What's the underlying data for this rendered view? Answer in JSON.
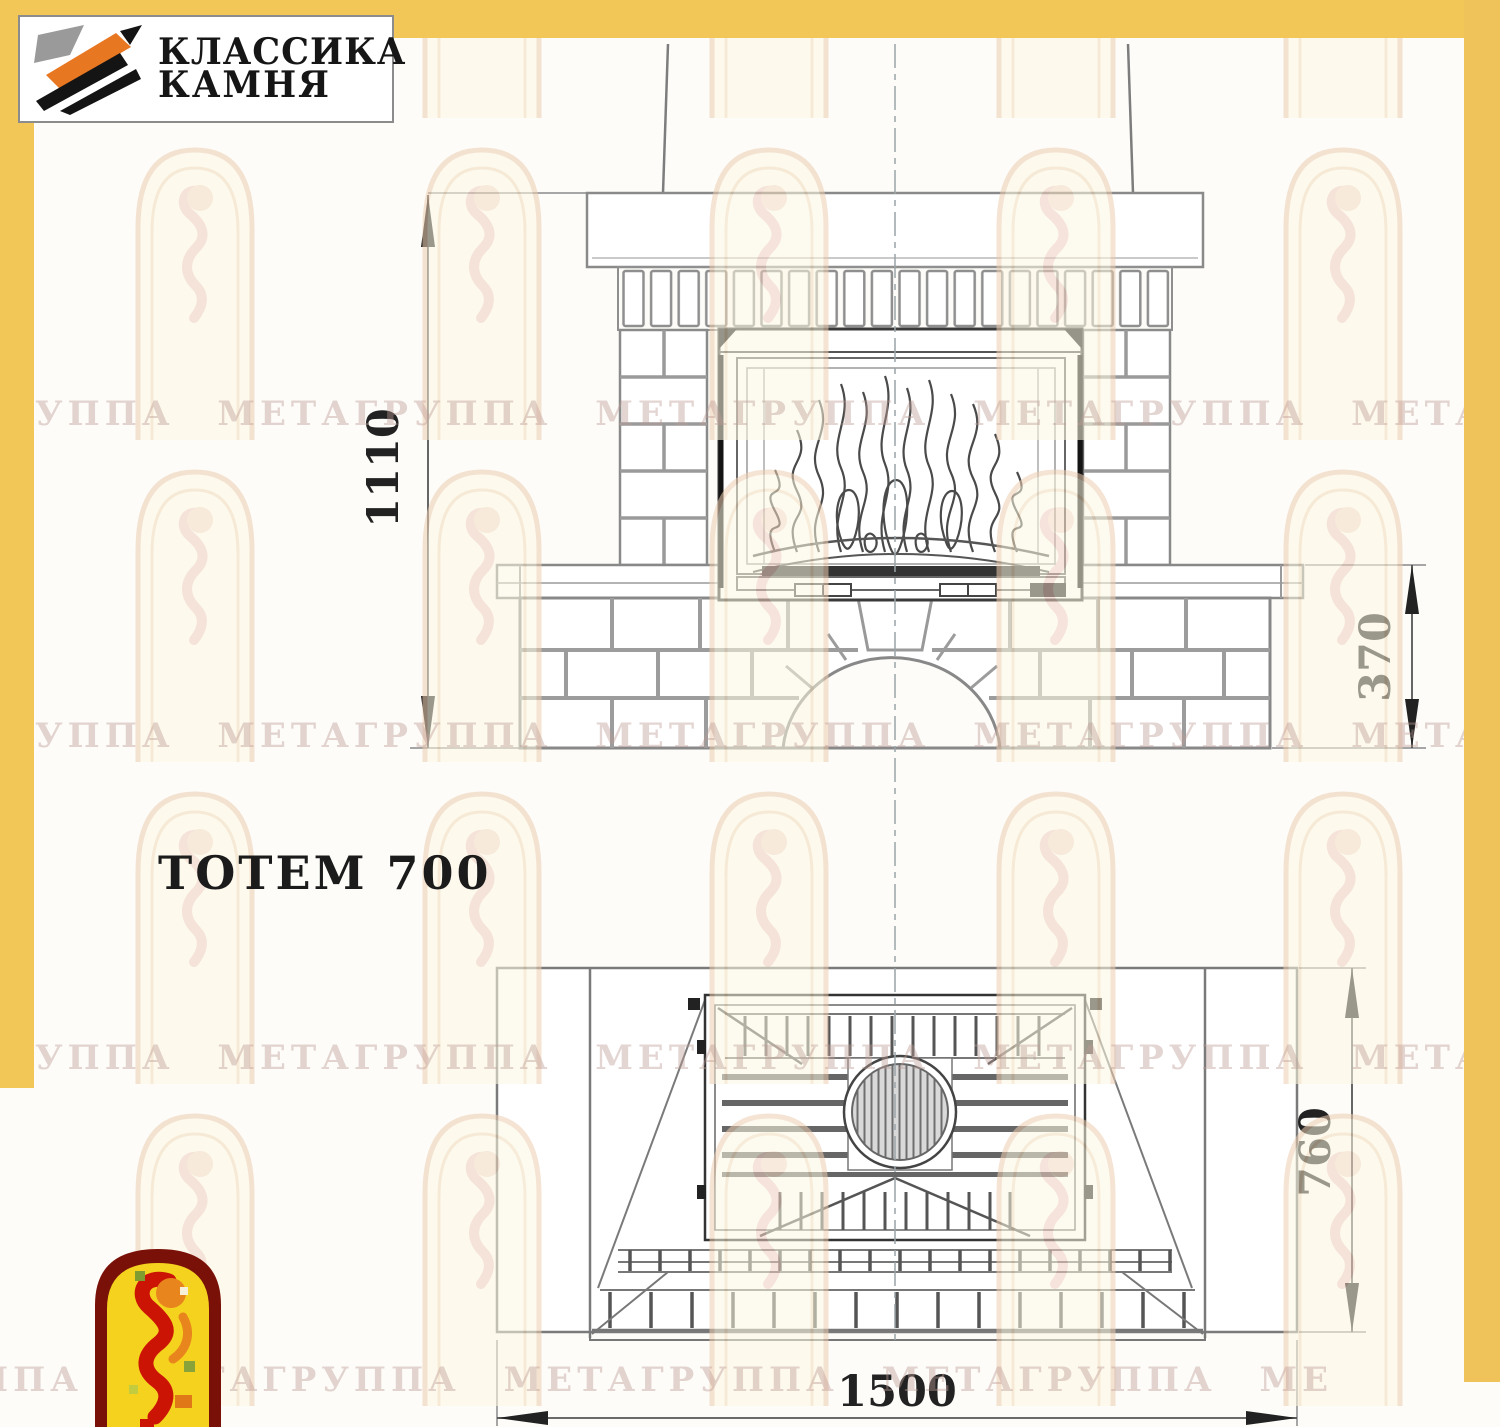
{
  "page": {
    "title": "ТОТЕМ 700"
  },
  "logo": {
    "line1": "КЛАССИКА",
    "line2": "КАМНЯ"
  },
  "dimensions": {
    "overall_height": "1110",
    "pedestal_height": "370",
    "depth": "760",
    "width": "1500"
  },
  "watermark": {
    "rows": [
      "ГРУППА МЕТАГРУППА МЕТАГРУППА МЕТАГРУППА МЕТА",
      "ГРУППА МЕТАГРУППА МЕТАГРУППА МЕТАГРУППА МЕТА",
      "ГРУППА МЕТАГРУППА МЕТАГРУППА МЕТАГРУППА МЕТА",
      "ППА МЕТАГРУППА МЕТАГРУППА МЕТАГРУППА МЕ"
    ]
  },
  "colors": {
    "border_yellow": "#f2c657",
    "logo_orange": "#e87722",
    "logo_black": "#161616",
    "emblem_border": "#7a1108",
    "emblem_fill": "#f4d21e",
    "emblem_red": "#cc1405",
    "drawing_line_gray": "#8a8a8a",
    "drawing_line_dark": "#3a3a3a"
  }
}
